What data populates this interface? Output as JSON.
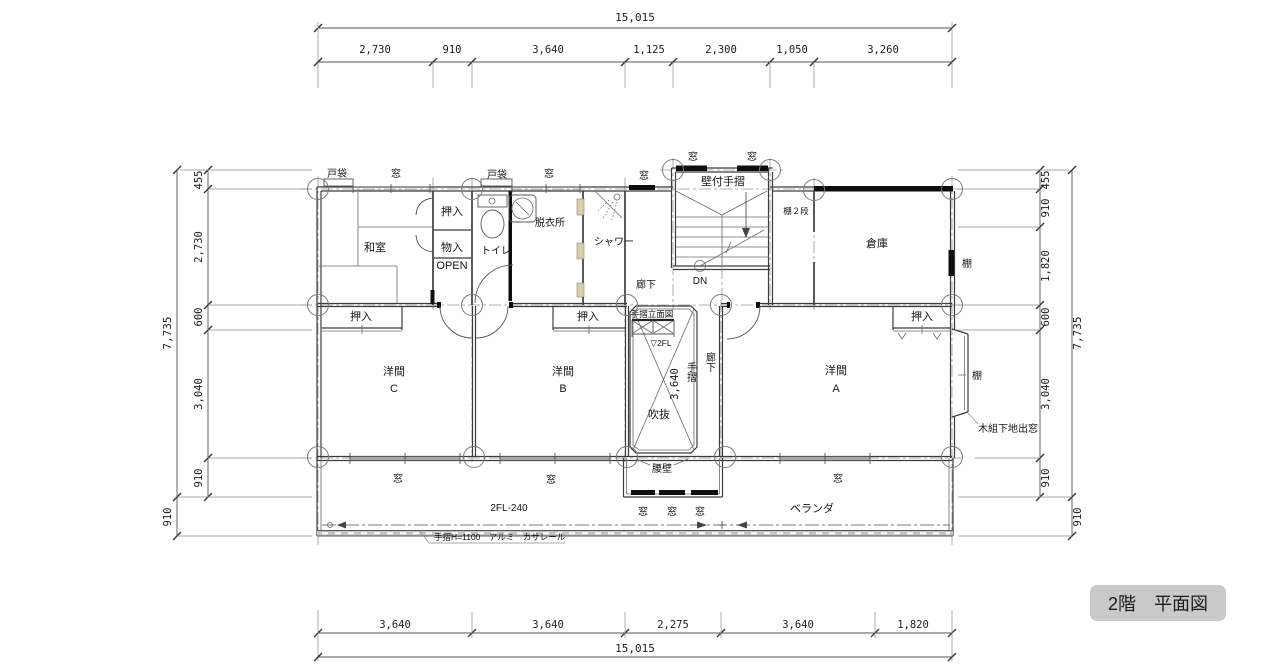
{
  "title": "2階　平面図",
  "dims": {
    "top_total": "15,015",
    "top": [
      "2,730",
      "910",
      "3,640",
      "1,125",
      "2,300",
      "1,050",
      "3,260"
    ],
    "bottom": [
      "3,640",
      "3,640",
      "2,275",
      "3,640",
      "1,820"
    ],
    "bottom_total": "15,015",
    "left_total": "7,735",
    "left": [
      "455",
      "2,730",
      "600",
      "3,040",
      "910"
    ],
    "left_outer": "910",
    "right_total": "7,735",
    "right": [
      "455",
      "910",
      "1,820",
      "600",
      "3,040",
      "910"
    ],
    "right_outer": "910",
    "void_height": "3,640"
  },
  "rooms": {
    "washitsu": "和室",
    "toilet": "トイレ",
    "datsuijo": "脱衣所",
    "shower": "シャワー",
    "souko": "倉庫",
    "youma": "洋間",
    "youma_a": "A",
    "youma_b": "B",
    "youma_c": "C",
    "fukinuke": "吹抜",
    "rouka": "廊下",
    "veranda": "ベランダ"
  },
  "labels": {
    "mado": "窓",
    "tobukuro": "戸袋",
    "oshiire": "押入",
    "mononyu": "物入",
    "open": "OPEN",
    "kabetsuke_tesuri": "壁付手摺",
    "tana_2dan": "棚２段",
    "dn": "DN",
    "tesuri_ritsumenzu": "手摺立面図",
    "fl2": "▽2FL",
    "tesuri": "手摺",
    "koshikabe": "腰壁",
    "fl_level": "2FL-240",
    "tesuri_spec": "手摺H=1100　アルミ　カサレール",
    "kigumi_demado": "木組下地出窓",
    "tana": "棚"
  },
  "colors": {
    "line": "#3c3c3c",
    "black_fill": "#0d0d0d",
    "title_bg": "#c9c9c9",
    "door_panel": "#d8cfa8"
  }
}
